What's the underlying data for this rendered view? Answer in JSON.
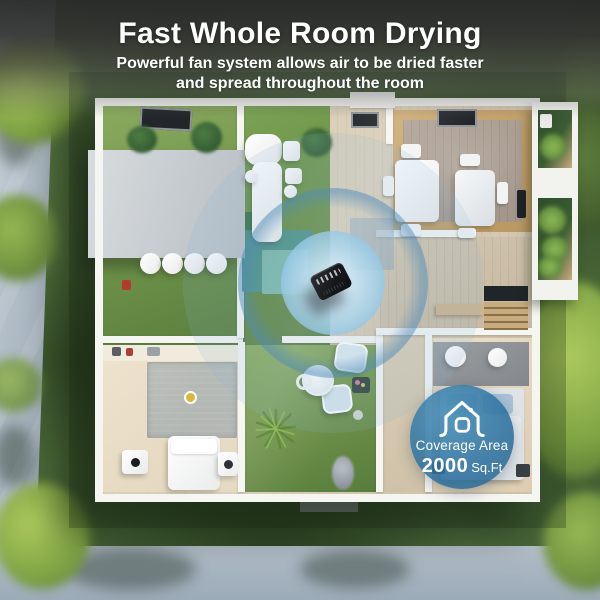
{
  "header": {
    "title": "Fast Whole Room Drying",
    "subtitle_line1": "Powerful fan system allows air to be dried faster",
    "subtitle_line2": "and spread throughout the room"
  },
  "coverage_badge": {
    "label": "Coverage Area",
    "value": "2000",
    "unit": "Sq.Ft"
  },
  "scene": {
    "device_icon": "dehumidifier-top-view",
    "airflow_icon": "concentric-airflow-circles",
    "badge_icon": "house-outline-icon"
  },
  "colors": {
    "airflow_blue": "#7fb3d6",
    "badge_blue": "#2d76a8",
    "header_overlay_gray": "#3c3c3c",
    "grass_green": "#567440",
    "road_gray": "#a9b7c3",
    "device_black": "#17191c"
  }
}
